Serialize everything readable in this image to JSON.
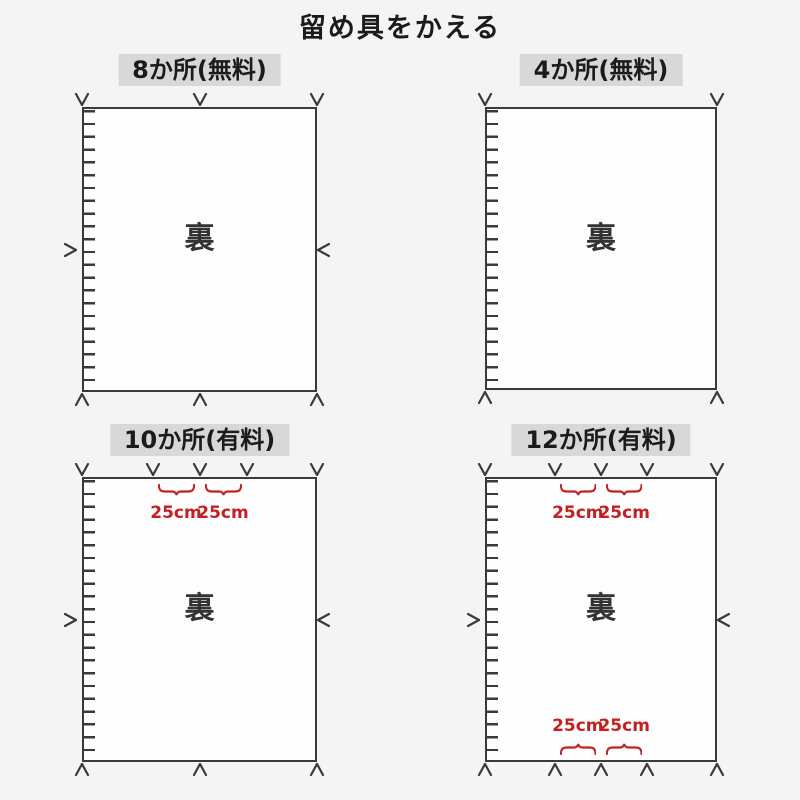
{
  "title": "留め具をかえる",
  "back_label": "裏",
  "measure_text": "25cm",
  "colors": {
    "background": "#f4f4f4",
    "line": "#3a3a3a",
    "sheet_fill": "#fdfdfd",
    "label_background": "#d8d8d8",
    "text": "#1b1b1b",
    "measure_red": "#c32121"
  },
  "panels": [
    {
      "id": "spots-8-free",
      "label": "8か所(無料)",
      "fastener_count": 8,
      "top_fasteners": 3,
      "bottom_fasteners": 3,
      "left_fastener": true,
      "right_fastener": true,
      "top_measures": 0,
      "bottom_measures": 0
    },
    {
      "id": "spots-4-free",
      "label": "4か所(無料)",
      "fastener_count": 4,
      "top_fasteners": 2,
      "bottom_fasteners": 2,
      "left_fastener": false,
      "right_fastener": false,
      "top_measures": 0,
      "bottom_measures": 0
    },
    {
      "id": "spots-10-paid",
      "label": "10か所(有料)",
      "fastener_count": 10,
      "top_fasteners": 5,
      "bottom_fasteners": 3,
      "left_fastener": true,
      "right_fastener": true,
      "top_measures": 2,
      "bottom_measures": 0
    },
    {
      "id": "spots-12-paid",
      "label": "12か所(有料)",
      "fastener_count": 12,
      "top_fasteners": 5,
      "bottom_fasteners": 5,
      "left_fastener": true,
      "right_fastener": true,
      "top_measures": 2,
      "bottom_measures": 2
    }
  ]
}
